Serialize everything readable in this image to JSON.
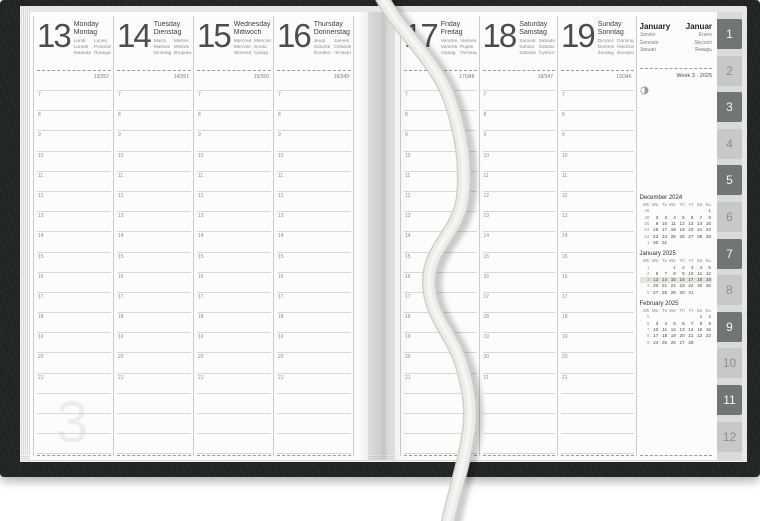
{
  "meta": {
    "title": "Weekly planner spread — Week 3, January 2025"
  },
  "colors": {
    "cover": "#242928",
    "page": "#fcfcfb",
    "grid_line": "#d7d7d5",
    "grid_strong": "#cccccb",
    "dashed_line": "#9c9c9a",
    "highlight_row": "#e4e4e1",
    "tab_dark": "#6f7674",
    "tab_dark_text": "#f4f5f4",
    "tab_light": "#c6c9c8",
    "tab_light_text": "#8a8f8e",
    "ribbon": "#ebebe8",
    "ribbon_edge": "#d0d0cb",
    "ribbon_highlight": "#f7f7f5"
  },
  "hours": [
    "7",
    "8",
    "9",
    "10",
    "11",
    "12",
    "13",
    "14",
    "15",
    "16",
    "17",
    "18",
    "19",
    "20",
    "21"
  ],
  "blank_rows_after_hours": 3,
  "left_page": {
    "week_watermark": "3",
    "days": [
      {
        "num": "13",
        "name": "Monday",
        "name_local": "Montag",
        "names_intl_left": [
          "Lundi",
          "Lunedì",
          "Maandag"
        ],
        "names_intl_right": [
          "Lunes",
          "Poniedziałek",
          "Понедельник"
        ],
        "day_of_year": "13/352"
      },
      {
        "num": "14",
        "name": "Tuesday",
        "name_local": "Dienstag",
        "names_intl_left": [
          "Mardi",
          "Martedì",
          "Dinsdag"
        ],
        "names_intl_right": [
          "Martes",
          "Wtorek",
          "Вторник"
        ],
        "day_of_year": "14/351"
      },
      {
        "num": "15",
        "name": "Wednesday",
        "name_local": "Mittwoch",
        "names_intl_left": [
          "Mercredi",
          "Mercoledì",
          "Woensdag"
        ],
        "names_intl_right": [
          "Miércoles",
          "Środa",
          "Среда"
        ],
        "day_of_year": "15/350"
      },
      {
        "num": "16",
        "name": "Thursday",
        "name_local": "Donnerstag",
        "names_intl_left": [
          "Jeudi",
          "Giovedì",
          "Donderdag"
        ],
        "names_intl_right": [
          "Jueves",
          "Czwartek",
          "Четверг"
        ],
        "day_of_year": "16/349"
      }
    ]
  },
  "right_page": {
    "days": [
      {
        "num": "17",
        "name": "Friday",
        "name_local": "Freitag",
        "names_intl_left": [
          "Vendredi",
          "Venerdì",
          "Vrijdag"
        ],
        "names_intl_right": [
          "Viernes",
          "Piątek",
          "Пятница"
        ],
        "day_of_year": "17/348"
      },
      {
        "num": "18",
        "name": "Saturday",
        "name_local": "Samstag",
        "names_intl_left": [
          "Samedi",
          "Sabato",
          "Zaterdag"
        ],
        "names_intl_right": [
          "Sábado",
          "Sobota",
          "Суббота"
        ],
        "day_of_year": "18/347"
      },
      {
        "num": "19",
        "name": "Sunday",
        "name_local": "Sonntag",
        "names_intl_left": [
          "Dimanche",
          "Domenica",
          "Zondag"
        ],
        "names_intl_right": [
          "Domingo",
          "Niedziela",
          "Воскресенье"
        ],
        "day_of_year": "19/346"
      }
    ],
    "month_panel": {
      "name": "January",
      "name_local": "Januar",
      "names_intl_left": [
        "Janvier",
        "Gennaio",
        "Januari"
      ],
      "names_intl_right": [
        "Enero",
        "Styczeń",
        "Январь"
      ],
      "week_label": "Week 3 · 2025",
      "moon_icon": "moon-phase-icon",
      "mini_calendars": [
        {
          "title": "December 2024",
          "col_headers": [
            "Wk",
            "Mo",
            "Tu",
            "We",
            "Th",
            "Fr",
            "Sa",
            "Su"
          ],
          "rows": [
            [
              "48",
              "",
              "",
              "",
              "",
              "",
              "",
              "1"
            ],
            [
              "49",
              "2",
              "3",
              "4",
              "5",
              "6",
              "7",
              "8"
            ],
            [
              "50",
              "9",
              "10",
              "11",
              "12",
              "13",
              "14",
              "15"
            ],
            [
              "51",
              "16",
              "17",
              "18",
              "19",
              "20",
              "21",
              "22"
            ],
            [
              "52",
              "23",
              "24",
              "25",
              "26",
              "27",
              "28",
              "29"
            ],
            [
              "1",
              "30",
              "31",
              "",
              "",
              "",
              "",
              ""
            ]
          ],
          "highlight_row_index": null
        },
        {
          "title": "January 2025",
          "col_headers": [
            "Wk",
            "Mo",
            "Tu",
            "We",
            "Th",
            "Fr",
            "Sa",
            "Su"
          ],
          "rows": [
            [
              "1",
              "",
              "",
              "1",
              "2",
              "3",
              "4",
              "5"
            ],
            [
              "2",
              "6",
              "7",
              "8",
              "9",
              "10",
              "11",
              "12"
            ],
            [
              "3",
              "13",
              "14",
              "15",
              "16",
              "17",
              "18",
              "19"
            ],
            [
              "4",
              "20",
              "21",
              "22",
              "23",
              "24",
              "25",
              "26"
            ],
            [
              "5",
              "27",
              "28",
              "29",
              "30",
              "31",
              "",
              ""
            ]
          ],
          "highlight_row_index": 2
        },
        {
          "title": "February 2025",
          "col_headers": [
            "Wk",
            "Mo",
            "Tu",
            "We",
            "Th",
            "Fr",
            "Sa",
            "Su"
          ],
          "rows": [
            [
              "5",
              "",
              "",
              "",
              "",
              "",
              "1",
              "2"
            ],
            [
              "6",
              "3",
              "4",
              "5",
              "6",
              "7",
              "8",
              "9"
            ],
            [
              "7",
              "10",
              "11",
              "12",
              "13",
              "14",
              "15",
              "16"
            ],
            [
              "8",
              "17",
              "18",
              "19",
              "20",
              "21",
              "22",
              "23"
            ],
            [
              "9",
              "24",
              "25",
              "26",
              "27",
              "28",
              "",
              ""
            ]
          ],
          "highlight_row_index": null
        }
      ]
    }
  },
  "tabs": [
    {
      "label": "1",
      "emphasis": "dark"
    },
    {
      "label": "2",
      "emphasis": "light"
    },
    {
      "label": "3",
      "emphasis": "dark"
    },
    {
      "label": "4",
      "emphasis": "light"
    },
    {
      "label": "5",
      "emphasis": "dark"
    },
    {
      "label": "6",
      "emphasis": "light"
    },
    {
      "label": "7",
      "emphasis": "dark"
    },
    {
      "label": "8",
      "emphasis": "light"
    },
    {
      "label": "9",
      "emphasis": "dark"
    },
    {
      "label": "10",
      "emphasis": "light"
    },
    {
      "label": "11",
      "emphasis": "dark"
    },
    {
      "label": "12",
      "emphasis": "light"
    }
  ]
}
